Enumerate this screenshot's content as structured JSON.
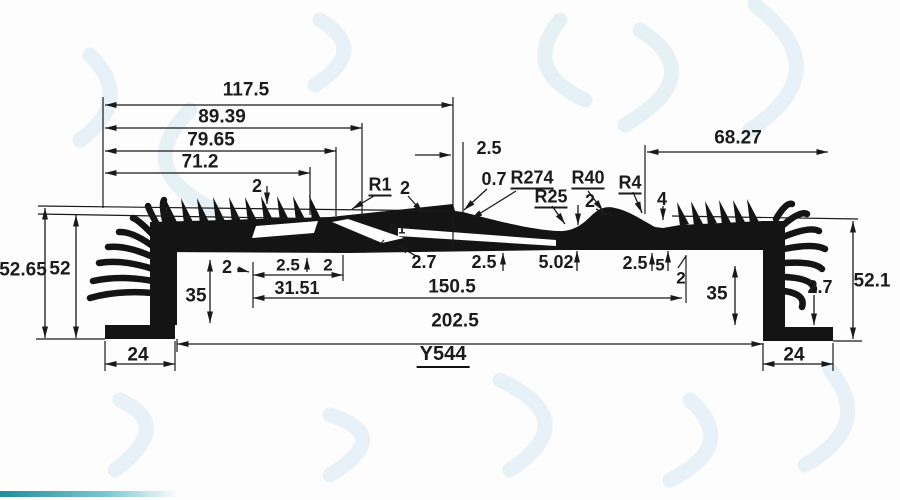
{
  "drawing": {
    "part_label": "Y544",
    "top_dims": {
      "overall": "117.5",
      "a": "89.39",
      "b": "79.65",
      "c": "71.2",
      "gap": "2",
      "step": "2.5"
    },
    "radius_labels": {
      "r1": "R1",
      "r1_thk": "2",
      "r1_inner": "R1",
      "step_small": "0.7",
      "r274": "R274",
      "r25": "R25",
      "r40": "R40",
      "dome_thk": "2",
      "r4": "R4",
      "bump_h": "4"
    },
    "left_dims": {
      "height_outer": "52.65",
      "height": "52",
      "cavity": "35",
      "lip": "2",
      "foot": "24"
    },
    "right_dims": {
      "top_width": "68.27",
      "height": "52.1",
      "cavity": "35",
      "base_thk": "2.7",
      "foot": "24"
    },
    "bottom_dims": {
      "t_a": "2.5",
      "t_b": "2",
      "w_slot": "31.51",
      "t_c": "2.7",
      "t_d": "2.5",
      "t_e": "5.02",
      "t_f": "2.5",
      "t_g": "5",
      "t_h": "2",
      "inner": "150.5",
      "overall": "202.5"
    },
    "accent_colors": {
      "ink": "#1a1a1a",
      "watermark": "#e4f0f6",
      "teal_bar": "#1f8d9b"
    }
  }
}
